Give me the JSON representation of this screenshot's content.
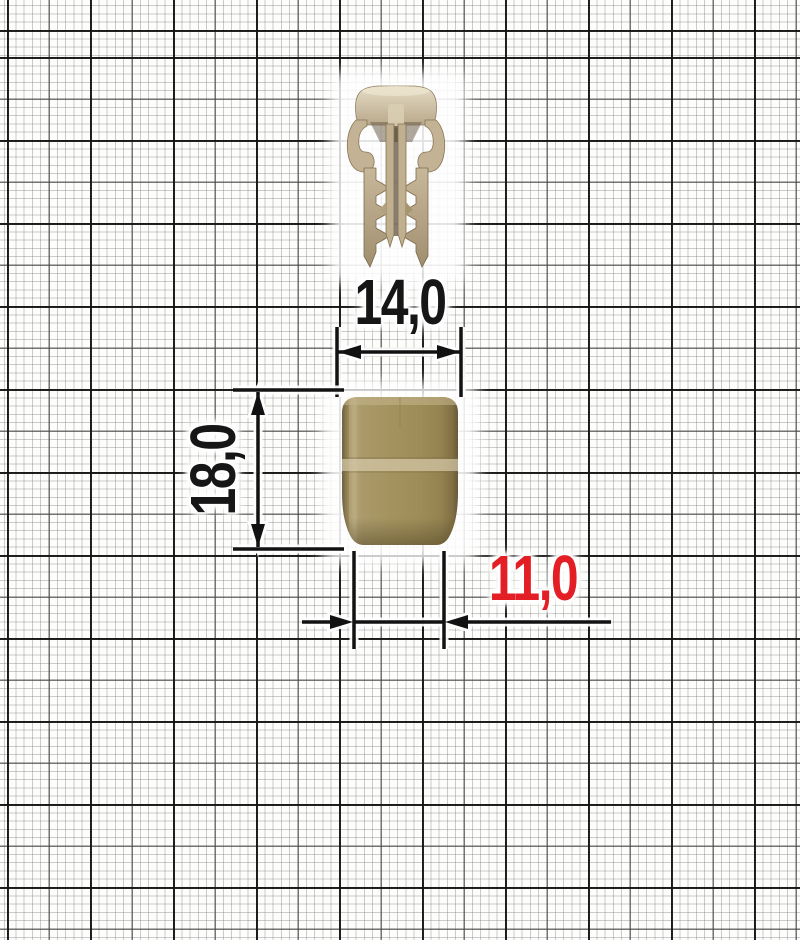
{
  "dimensions": {
    "top_width": {
      "value": "14,0",
      "color": "#161616"
    },
    "height": {
      "value": "18,0",
      "color": "#161616"
    },
    "bottom_width": {
      "value": "11,0",
      "color": "#e31e24"
    }
  },
  "colors": {
    "dimension_accent_red": "#e31e24",
    "dimension_ink": "#121212",
    "product_beige": "#a2905e",
    "product_beige_light": "#d2c7a6",
    "product_beige_dark": "#6e603f",
    "paper_background": "#fdfdfb"
  }
}
